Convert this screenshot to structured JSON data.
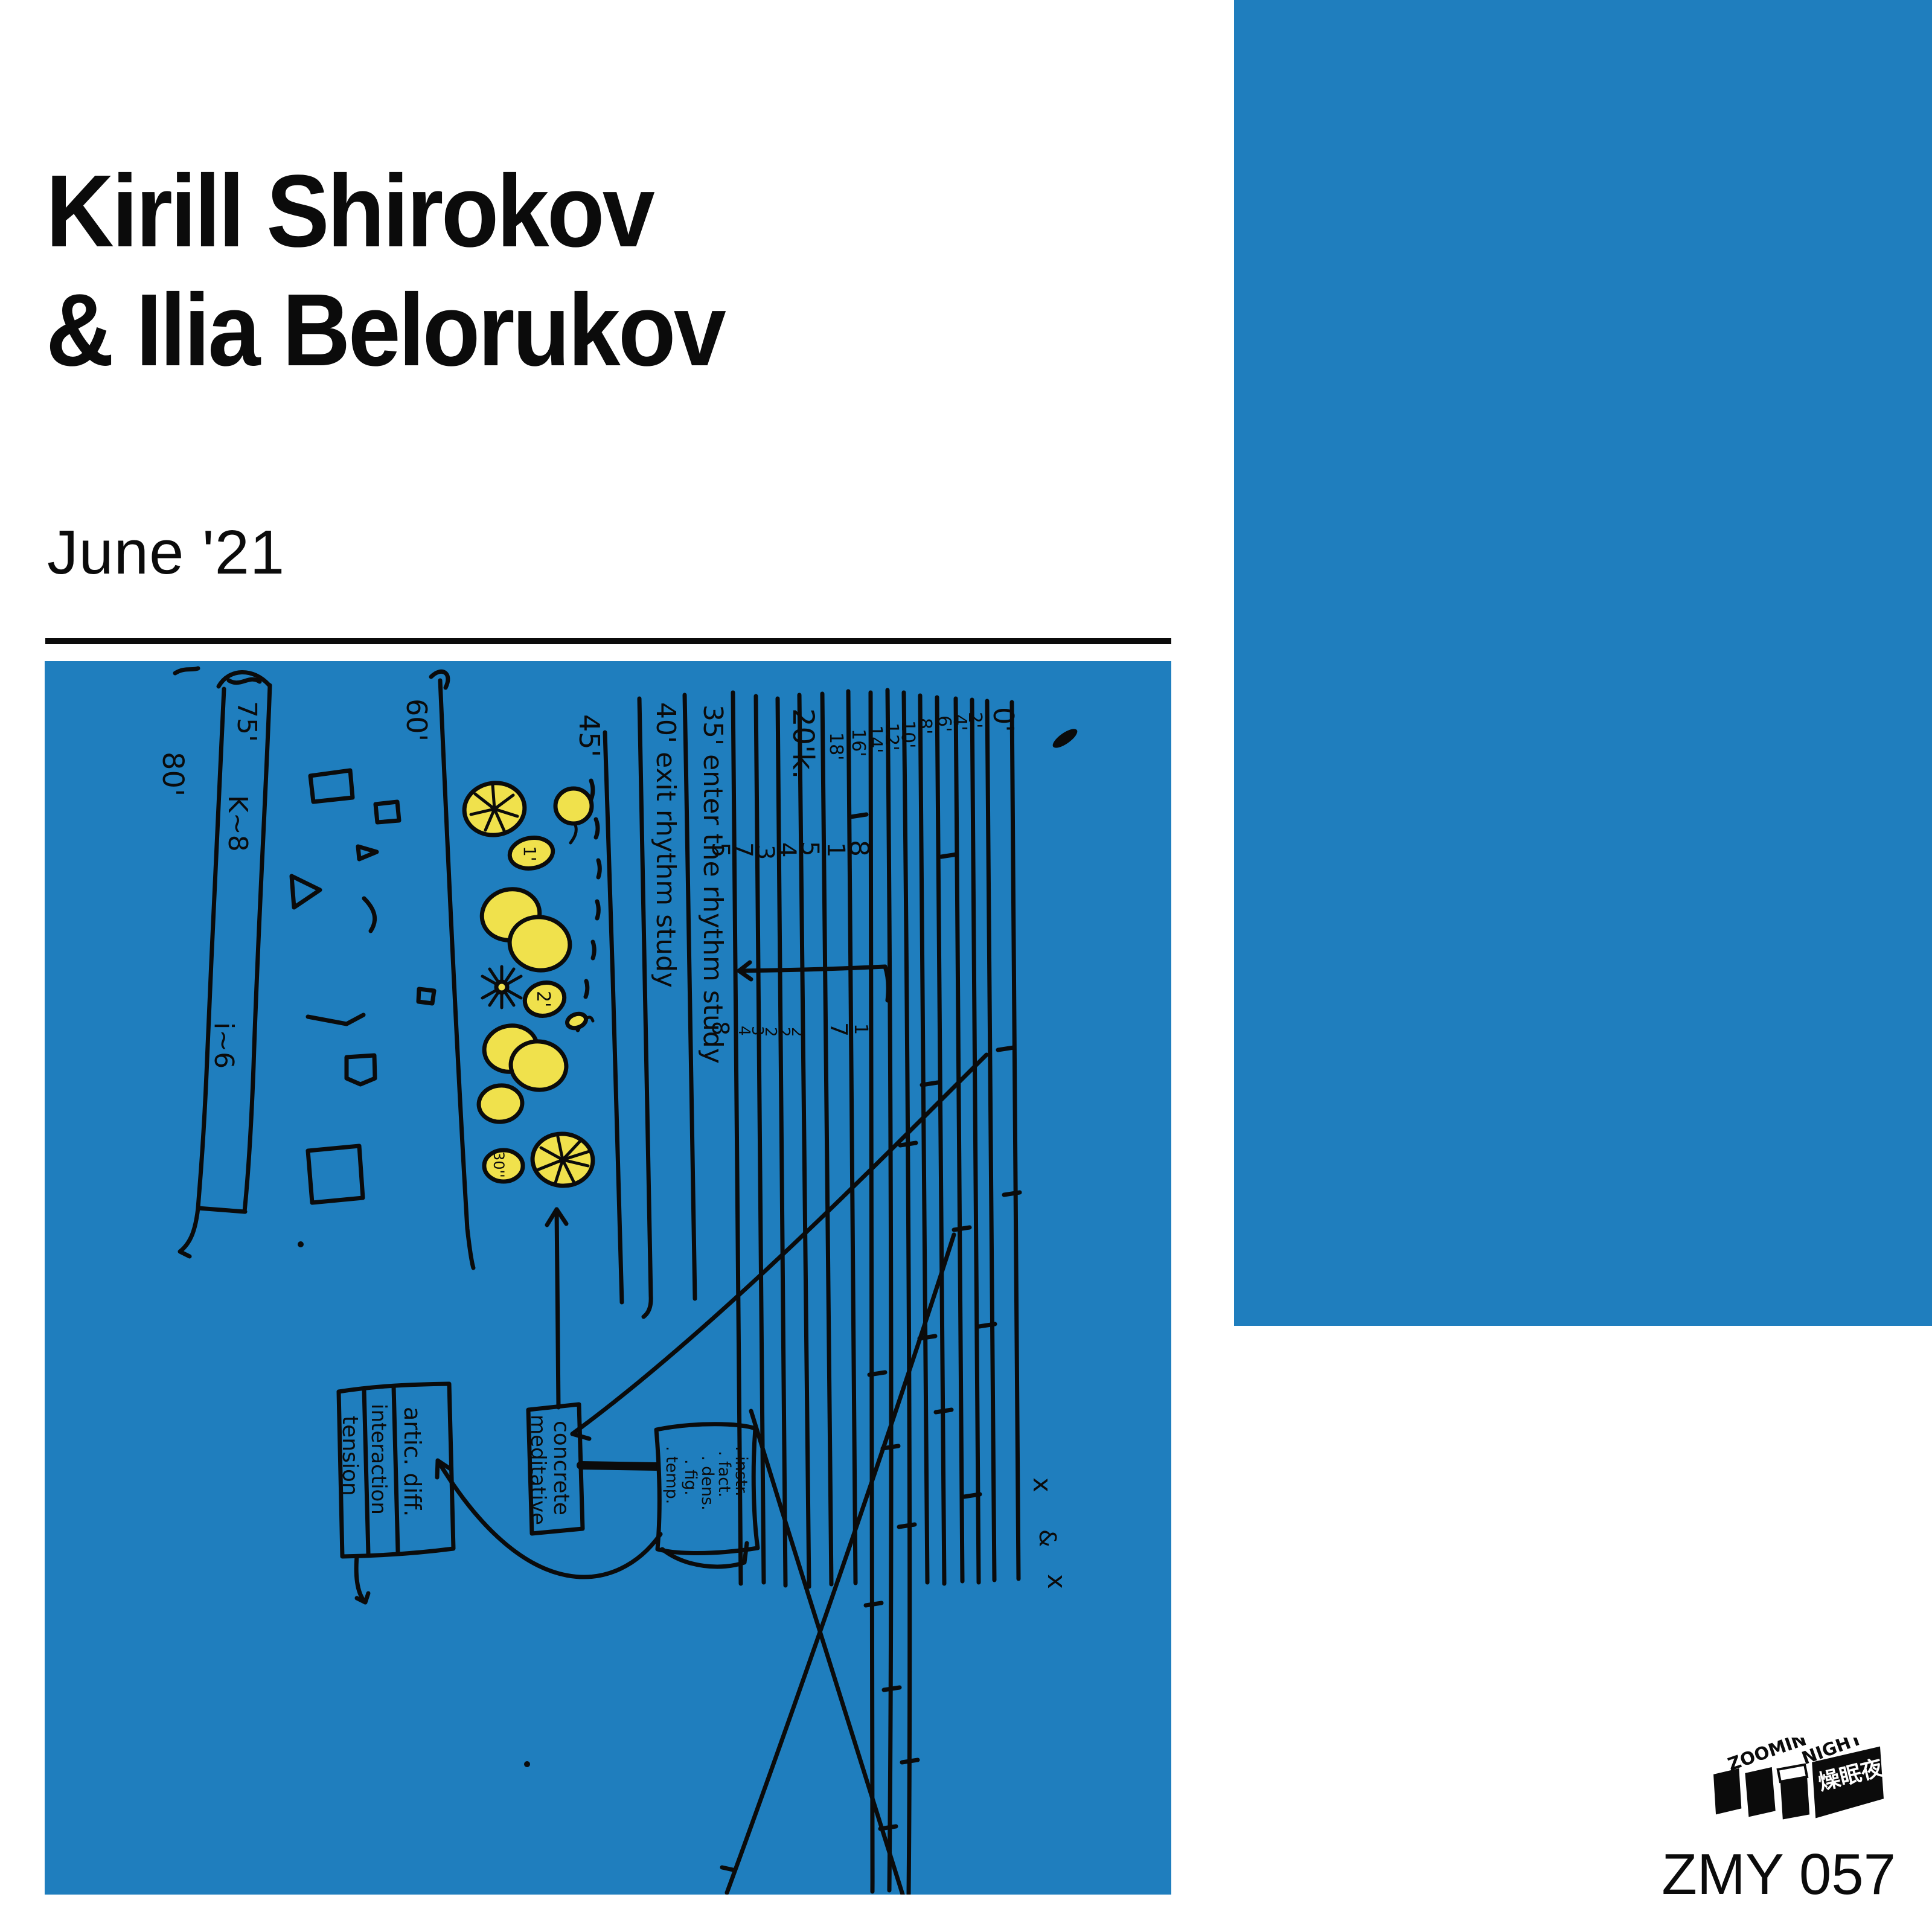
{
  "colors": {
    "background": "#FFFFFF",
    "blue": "#1F7EBE",
    "yellow": "#F0E14C",
    "ink": "#0B0B0B"
  },
  "header": {
    "artist_line1": "Kirill Shirokov",
    "artist_line2": "& Ilia Belorukov",
    "date": "June '21"
  },
  "score": {
    "timeline": {
      "outer": "80'",
      "top": "75'",
      "mid": "K~8",
      "low": "i~6"
    },
    "sections": {
      "s60": "60'",
      "s45": "45'",
      "s40": "40' exit rhythm study",
      "s35": "35' enter the rhythm study",
      "s20": "20'k."
    },
    "blob_labels": {
      "b1": "1'",
      "b2": "2'",
      "b30": "30''"
    },
    "string_top_labels": [
      "18'",
      "16'",
      "14'",
      "12'",
      "10'",
      "8'",
      "6'",
      "4'",
      "2'",
      "0'"
    ],
    "numbers_row1": [
      "5",
      "7",
      "3",
      "4",
      "5",
      "1",
      "8"
    ],
    "numbers_row2": [
      "8",
      "4",
      "3",
      "2",
      "2",
      "2",
      "7",
      "1"
    ],
    "boxes": {
      "col1": "tension",
      "col2": "interaction",
      "col3": "artic. diff.",
      "concrete_line1": "concrete",
      "concrete_line2": "meditative",
      "instr_lines": [
        ". instr.",
        ". fact.",
        ". dens.",
        ". fig.",
        ". temp."
      ]
    },
    "annotation": {
      "x1": "x",
      "amp": "&",
      "x2": "x"
    }
  },
  "branding": {
    "logo_word1": "ZOOMIN'",
    "logo_word2": "NIGHT",
    "logo_cjk": "燥眠夜",
    "catalog": "ZMY 057"
  }
}
